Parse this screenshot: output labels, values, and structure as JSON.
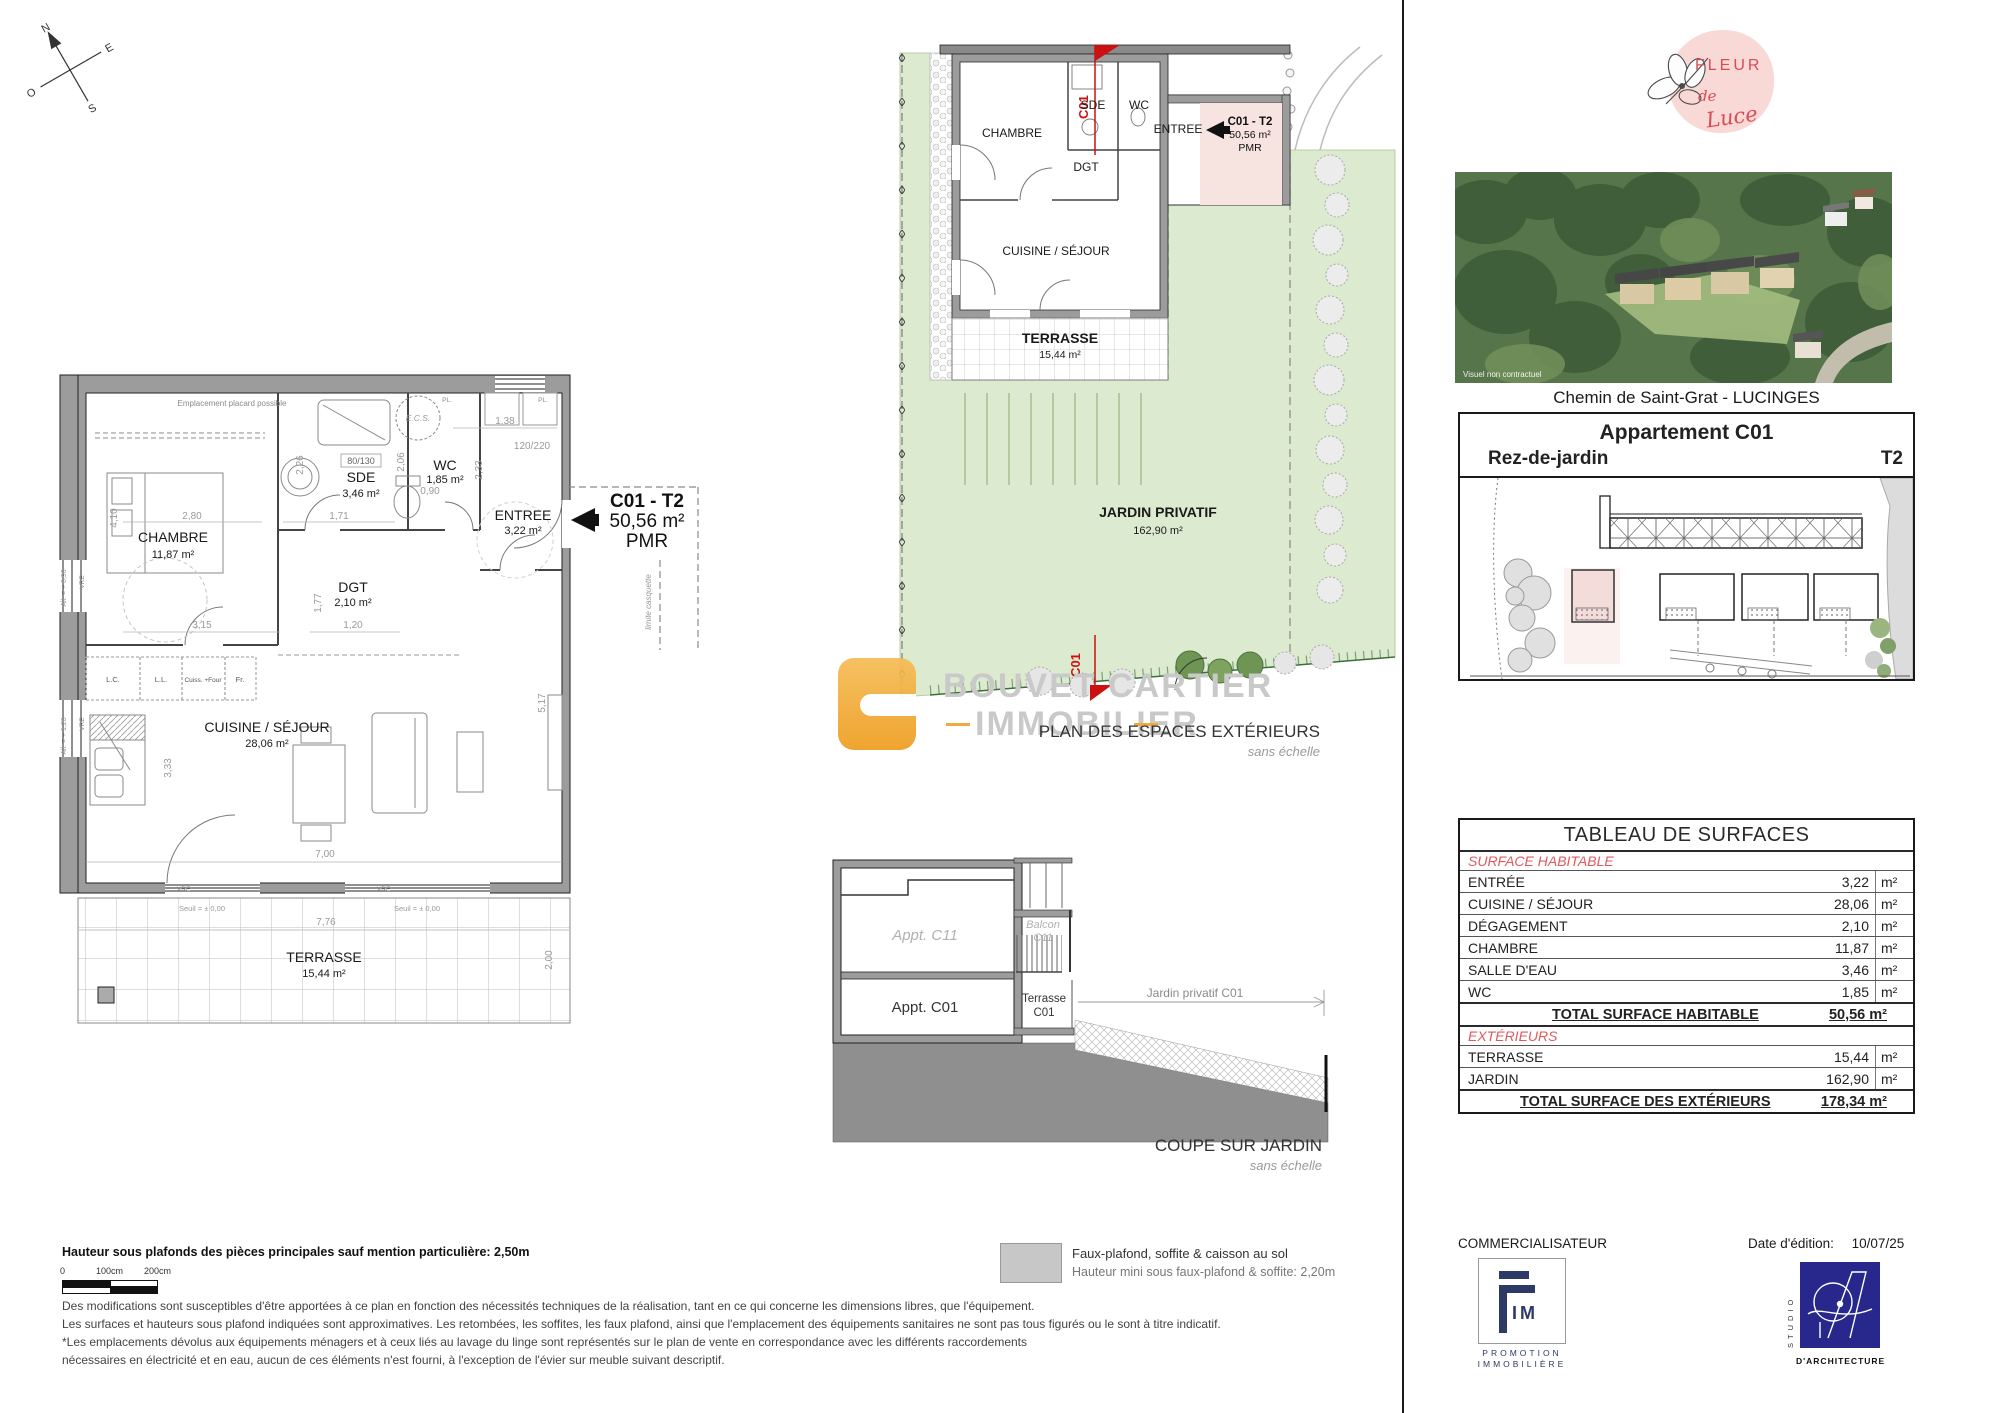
{
  "page": {
    "address": "Chemin de Saint-Grat - LUCINGES"
  },
  "logo": {
    "line1": "FLEUR",
    "line2": "de",
    "line3": "Luce"
  },
  "photo": {
    "caption": "Visuel non contractuel"
  },
  "header": {
    "title": "Appartement C01",
    "level": "Rez-de-jardin",
    "unit_type": "T2"
  },
  "badge": {
    "unit": "C01 - T2",
    "area": "50,56 m²",
    "pmr": "PMR"
  },
  "compass": {
    "n": "N",
    "s": "S",
    "e": "E",
    "o": "O"
  },
  "main_plan": {
    "rooms": {
      "chambre": {
        "name": "CHAMBRE",
        "area": "11,87 m²"
      },
      "sde": {
        "name": "SDE",
        "area": "3,46 m²"
      },
      "wc": {
        "name": "WC",
        "area": "1,85 m²"
      },
      "entree": {
        "name": "ENTREE",
        "area": "3,22 m²"
      },
      "dgt": {
        "name": "DGT",
        "area": "2,10 m²"
      },
      "cuisine": {
        "name": "CUISINE / SÉJOUR",
        "area": "28,06 m²"
      },
      "terrasse": {
        "name": "TERRASSE",
        "area": "15,44 m²"
      }
    },
    "kitchen": {
      "lc": "L.C.",
      "ll": "L.L.",
      "four": "Cuiss. +Four",
      "fr": "Fr."
    },
    "dims": {
      "d1": "2,80",
      "d2": "4,10",
      "d3": "1,71",
      "d4": "2,26",
      "d5": "2,06",
      "d6": "0,90",
      "d7": "1,38",
      "d8": "120/220",
      "d9": "2,33",
      "d10": "80/130",
      "d11": "3,15",
      "d12": "1,20",
      "d13": "1,77",
      "d14": "3,33",
      "d15": "7,00",
      "d16": "5,17",
      "d17": "7,76",
      "d18": "2,00"
    },
    "notes": {
      "placard": "Emplacement placard possible",
      "ecs": "E.C.S.",
      "pl": "PL.",
      "vre": "VRE",
      "seuil": "Seuil = ± 0,00",
      "all090": "All. = + 0,90",
      "all120": "All. = + 1,20",
      "limite": "limite casquette"
    }
  },
  "garden_plan": {
    "rooms": {
      "chambre": "CHAMBRE",
      "sde": "SDE",
      "wc": "WC",
      "entree": "ENTREE",
      "dgt": "DGT",
      "cuisine": "CUISINE / SÉJOUR"
    },
    "terrasse": {
      "name": "TERRASSE",
      "area": "15,44 m²"
    },
    "jardin": {
      "name": "JARDIN PRIVATIF",
      "area": "162,90 m²"
    },
    "marker": "C01",
    "title": "PLAN DES ESPACES EXTÉRIEURS",
    "subtitle": "sans échelle"
  },
  "coupe": {
    "appt_c11": "Appt. C11",
    "balcon_l1": "Balcon",
    "balcon_l2": "C11",
    "appt_c01": "Appt. C01",
    "terrasse_l1": "Terrasse",
    "terrasse_l2": "C01",
    "jardin_dim": "Jardin privatif C01",
    "title": "COUPE SUR JARDIN",
    "subtitle": "sans échelle"
  },
  "watermark": {
    "line1": "BOUVET CARTIER",
    "line2": "IMMOBILIER"
  },
  "surface_table": {
    "title": "TABLEAU DE SURFACES",
    "section1": "SURFACE HABITABLE",
    "rows1": [
      {
        "label": "ENTRÉE",
        "value": "3,22",
        "unit": "m²"
      },
      {
        "label": "CUISINE / SÉJOUR",
        "value": "28,06",
        "unit": "m²"
      },
      {
        "label": "DÉGAGEMENT",
        "value": "2,10",
        "unit": "m²"
      },
      {
        "label": "CHAMBRE",
        "value": "11,87",
        "unit": "m²"
      },
      {
        "label": "SALLE D'EAU",
        "value": "3,46",
        "unit": "m²"
      },
      {
        "label": "WC",
        "value": "1,85",
        "unit": "m²"
      }
    ],
    "total1": {
      "label": "TOTAL SURFACE HABITABLE",
      "value": "50,56 m²"
    },
    "section2": "EXTÉRIEURS",
    "rows2": [
      {
        "label": "TERRASSE",
        "value": "15,44",
        "unit": "m²"
      },
      {
        "label": "JARDIN",
        "value": "162,90",
        "unit": "m²"
      }
    ],
    "total2": {
      "label": "TOTAL SURFACE DES EXTÉRIEURS",
      "value": "178,34 m²"
    }
  },
  "footer": {
    "height_note": "Hauteur sous plafonds des pièces principales sauf mention particulière: 2,50m",
    "scale": {
      "t0": "0",
      "t1": "100cm",
      "t2": "200cm"
    },
    "legend_line1": "Faux-plafond, soffite & caisson au sol",
    "legend_line2": "Hauteur mini sous faux-plafond & soffite: 2,20m",
    "para1": "Des modifications sont susceptibles d'être apportées à ce plan en fonction des nécessités techniques de la réalisation, tant en ce qui concerne les dimensions libres, que l'équipement.",
    "para2": "Les surfaces et hauteurs sous plafond indiquées sont approximatives. Les retombées, les soffites, les faux plafond, ainsi que l'emplacement des équipements sanitaires ne sont pas tous figurés ou le sont à titre indicatif.",
    "para3": "*Les emplacements dévolus aux équipements ménagers et à ceux liés au lavage du linge sont représentés sur le plan de vente en correspondance avec les différents raccordements",
    "para4": "nécessaires en électricité et en eau, aucun de ces éléments n'est fourni, à l'exception de l'évier sur meuble suivant descriptif."
  },
  "commercial": {
    "label": "COMMERCIALISATEUR",
    "date_label": "Date d'édition:",
    "date": "10/07/25",
    "fim_im": "IM",
    "fim_line1": "PROMOTION",
    "fim_line2": "IMMOBILIÈRE",
    "studio_vertical": "STUDIO",
    "studio_label": "D'ARCHITECTURE"
  }
}
